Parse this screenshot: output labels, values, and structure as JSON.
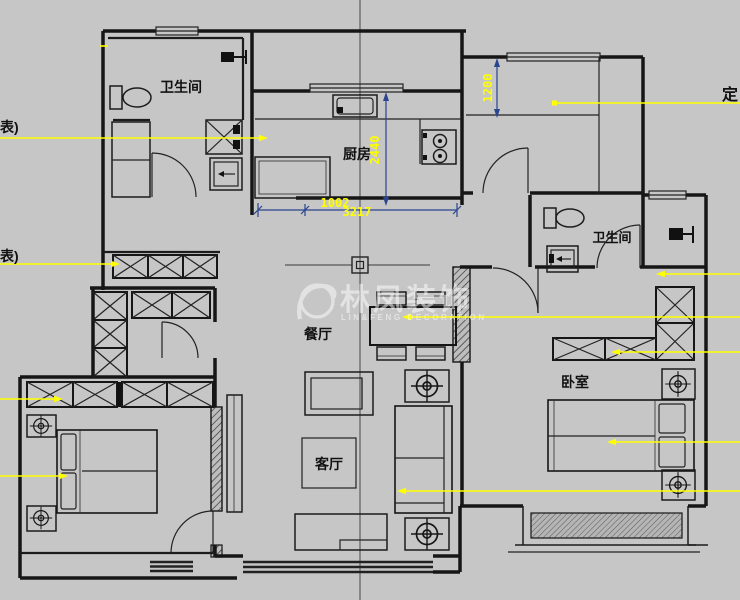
{
  "canvas": {
    "width": 740,
    "height": 600,
    "background": "#c6c6c6"
  },
  "colors": {
    "wall": "#161616",
    "leader_line": "#ffff00",
    "dimension_line": "#2b4590",
    "dimension_text": "#ffff00",
    "watermark": "rgba(255,255,255,0.5)"
  },
  "rooms": {
    "bathroom1": "卫生间",
    "kitchen": "厨房",
    "dining": "餐厅",
    "living": "客厅",
    "bathroom2": "卫生间",
    "bedroom": "卧室"
  },
  "dimensions": {
    "kitchen_depth": "2440",
    "closet_depth": "1200",
    "kitchen_width": "1002",
    "kitchen_width_overlap": "3217"
  },
  "edge_labels": {
    "left_upper": "表)",
    "left_lower": "表)",
    "right_upper": "定"
  },
  "watermark": {
    "title": "林凤装饰",
    "subtitle": "LIN&FENG DECORATION"
  }
}
